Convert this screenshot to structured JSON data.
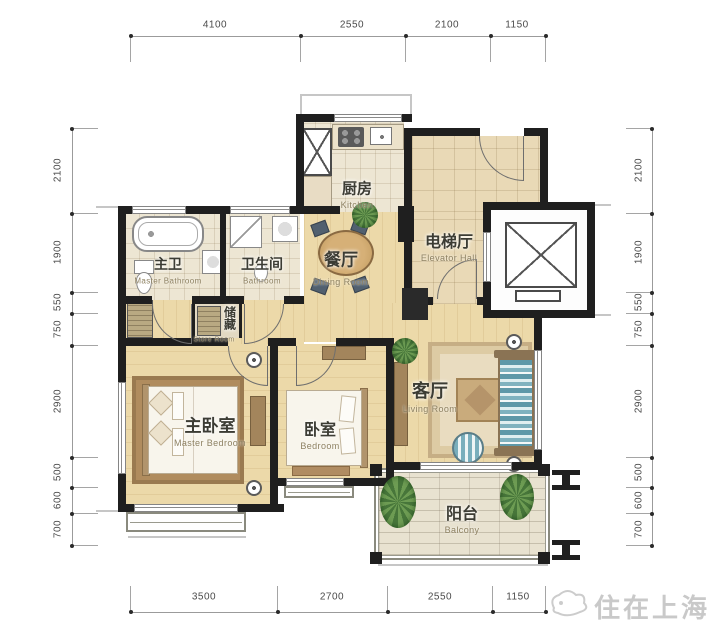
{
  "image": {
    "type": "apartment-floor-plan",
    "watermark": "住在上海"
  },
  "dimensions": {
    "top": [
      "4100",
      "2550",
      "2100",
      "1150"
    ],
    "bottom": [
      "3500",
      "2700",
      "2550",
      "1150"
    ],
    "left": [
      "2100",
      "1900",
      "550",
      "750",
      "2900",
      "500",
      "600",
      "700"
    ],
    "right": [
      "2100",
      "1900",
      "550",
      "750",
      "2900",
      "500",
      "600",
      "700"
    ]
  },
  "rooms": [
    {
      "id": "kitchen",
      "zh": "厨房",
      "en": "Kitchen"
    },
    {
      "id": "elevator-hall",
      "zh": "电梯厅",
      "en": "Elevator Hall"
    },
    {
      "id": "dining-room",
      "zh": "餐厅",
      "en": "Dining Room"
    },
    {
      "id": "master-bathroom",
      "zh": "主卫",
      "en": "Master Bathroom"
    },
    {
      "id": "bathroom",
      "zh": "卫生间",
      "en": "Bathroom"
    },
    {
      "id": "store-room",
      "zh": "储藏",
      "en": "Store Room"
    },
    {
      "id": "master-bedroom",
      "zh": "主卧室",
      "en": "Master Bedroom"
    },
    {
      "id": "bedroom",
      "zh": "卧室",
      "en": "Bedroom"
    },
    {
      "id": "living-room",
      "zh": "客厅",
      "en": "Living Room"
    },
    {
      "id": "balcony",
      "zh": "阳台",
      "en": "Balcony"
    }
  ],
  "colors": {
    "wall": "#1f1f1f",
    "wood_floor": "#ecd9a9",
    "tile_floor": "#ede6d3",
    "sofa_stripe": "#5e98a8",
    "plant_green": "#47763a",
    "label_text": "#3c3c34",
    "dimension_text": "#4a4a4a",
    "watermark_gray": "#c9c9c9"
  }
}
